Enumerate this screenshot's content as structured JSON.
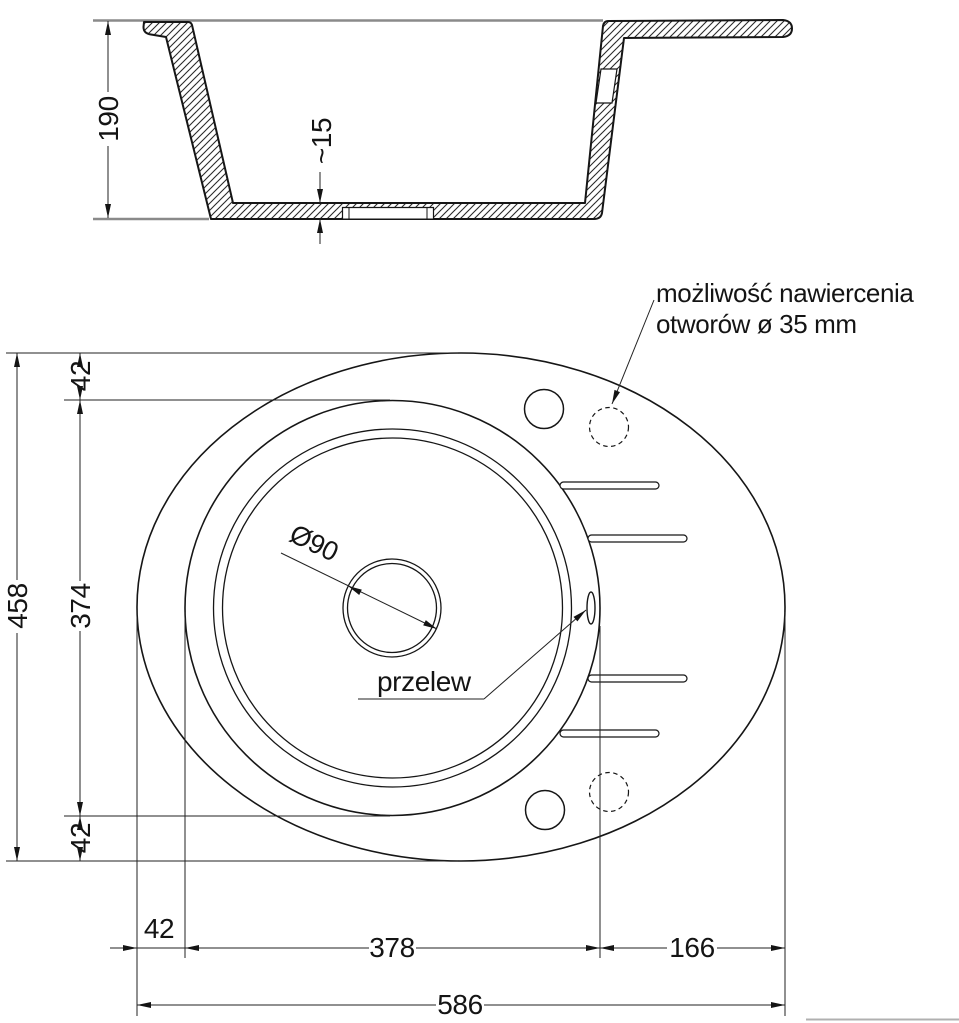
{
  "section_view": {
    "height": "190",
    "bottom_thickness": "~15"
  },
  "plan_view": {
    "drain_diameter": "Ø90",
    "overflow_label": "przelew",
    "note_line1": "możliwość nawiercenia",
    "note_line2": "otworów ø 35 mm"
  },
  "dimensions": {
    "total_width": "586",
    "bowl_width": "378",
    "right_section_width": "166",
    "left_margin": "42",
    "total_height": "458",
    "bowl_height": "374",
    "top_margin": "42",
    "bottom_margin": "42"
  }
}
